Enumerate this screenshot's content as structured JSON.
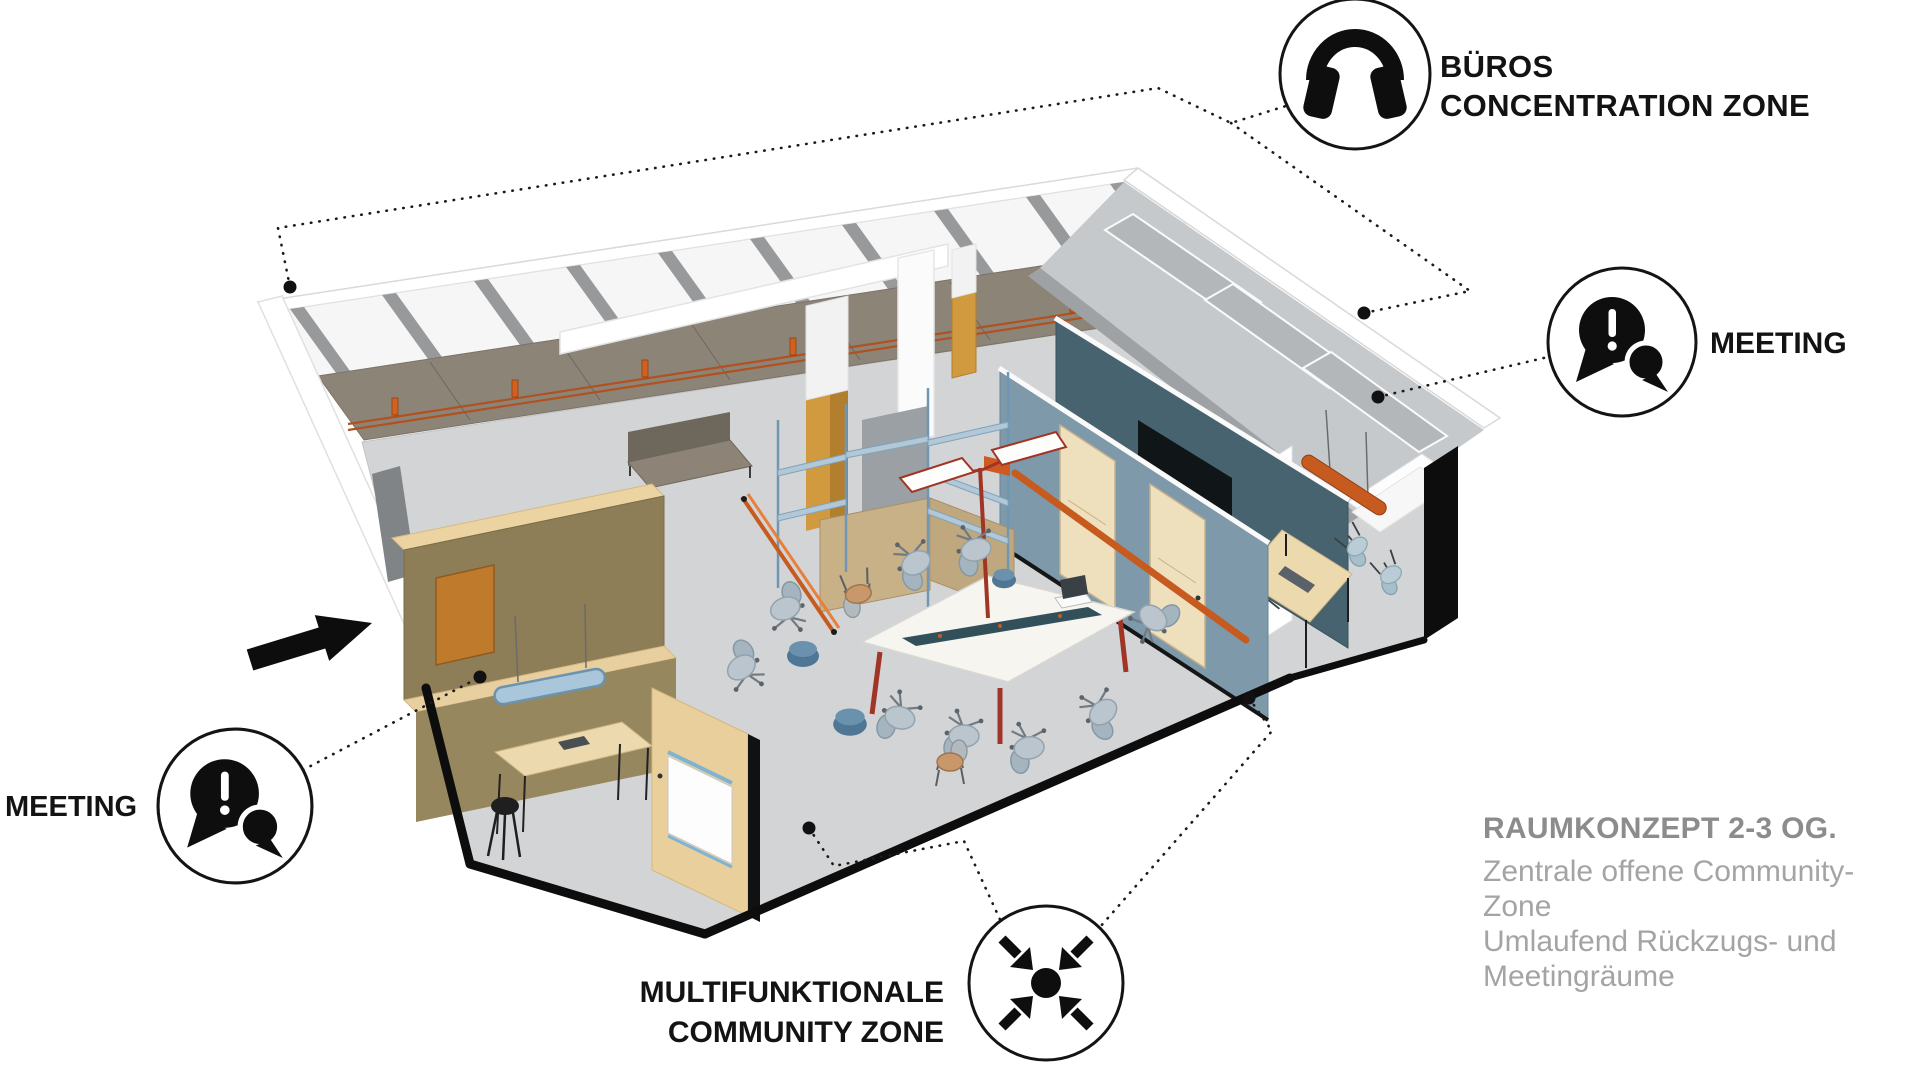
{
  "labels": {
    "buros": {
      "line1": "BÜROS",
      "line2": "CONCENTRATION ZONE"
    },
    "meeting_right": "MEETING",
    "meeting_left": "MEETING",
    "community": {
      "line1": "MULTIFUNKTIONALE",
      "line2": "COMMUNITY ZONE"
    }
  },
  "caption": {
    "title": "RAUMKONZEPT 2-3 OG.",
    "line1": "Zentrale offene Community-Zone",
    "line2": "Umlaufend Rückzugs- und",
    "line3": "Meetingräume"
  },
  "icons": {
    "buros": "headphones-icon",
    "meeting_right": "speech-bubbles-icon",
    "meeting_left": "speech-bubbles-icon",
    "community": "converging-arrows-icon",
    "entrance": "entrance-arrow-icon"
  },
  "colors": {
    "background": "#ffffff",
    "annotation_black": "#141414",
    "caption_title_gray": "#8c8c8c",
    "caption_body_gray": "#a4a4a4",
    "accent_orange": "#c75a1e",
    "wall_slate_blue": "#7e99a9",
    "wall_slate_dark": "#47636f",
    "wall_tan_cream": "#e9cf9c",
    "wall_olive": "#8e7e57",
    "wall_taupe": "#8d8478",
    "floor_gray": "#d3d4d6",
    "partition_gray": "#b4b7b9",
    "mustard": "#d29a3e",
    "table_white": "#f6f5ef",
    "pendant_blue": "#a9c6da",
    "chair_blue": "#b9cdd6"
  }
}
